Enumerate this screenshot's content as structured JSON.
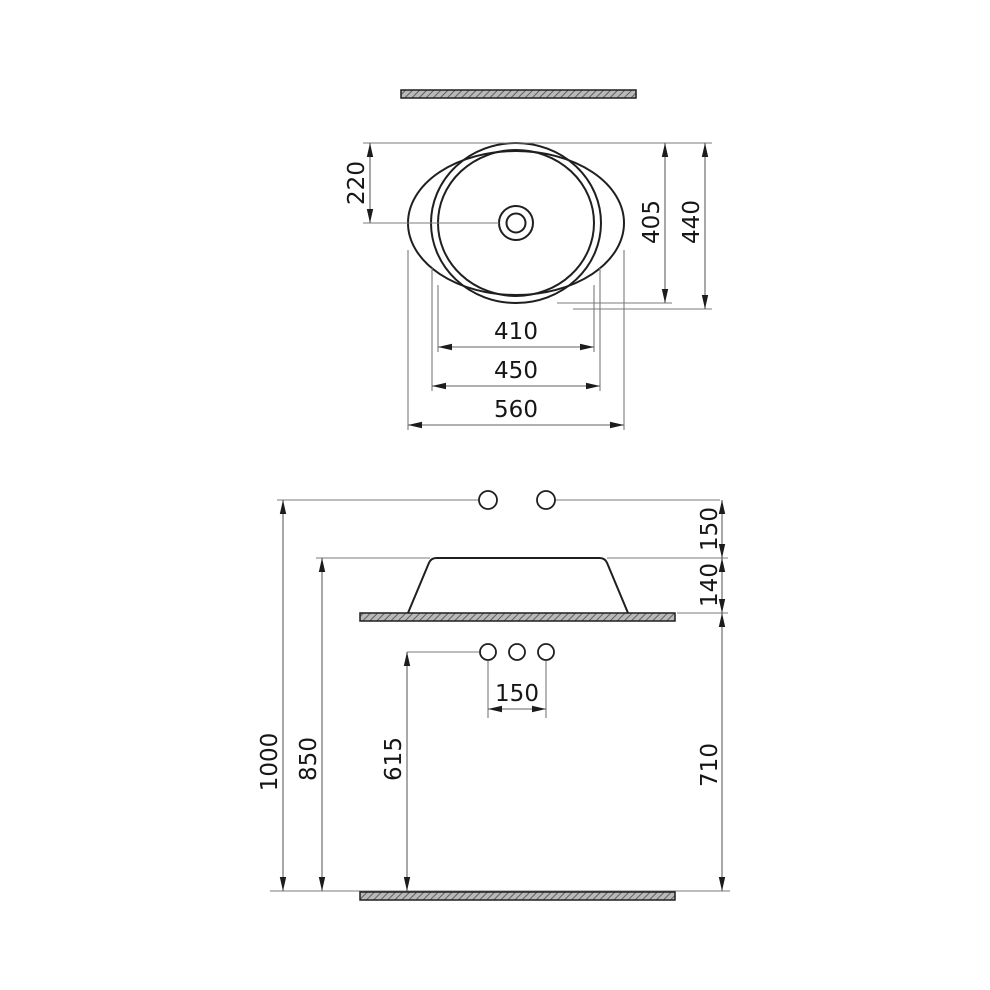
{
  "drawing": {
    "background_color": "#ffffff",
    "geometry_line_color": "#1f1f1f",
    "dimension_line_color": "#7b7b7b",
    "section_fill_color": "#b9b9b9"
  },
  "top_view": {
    "center_offset": "220",
    "bowl_inner_depth": "405",
    "overall_depth": "440",
    "bowl_inner_width": "410",
    "bowl_rim_width": "450",
    "overall_width": "560"
  },
  "side_view": {
    "reference_to_rim": "150",
    "basin_height": "140",
    "reference_height": "1000",
    "rim_height": "850",
    "drain_height": "615",
    "counter_height": "710",
    "hole_spacing": "150"
  }
}
